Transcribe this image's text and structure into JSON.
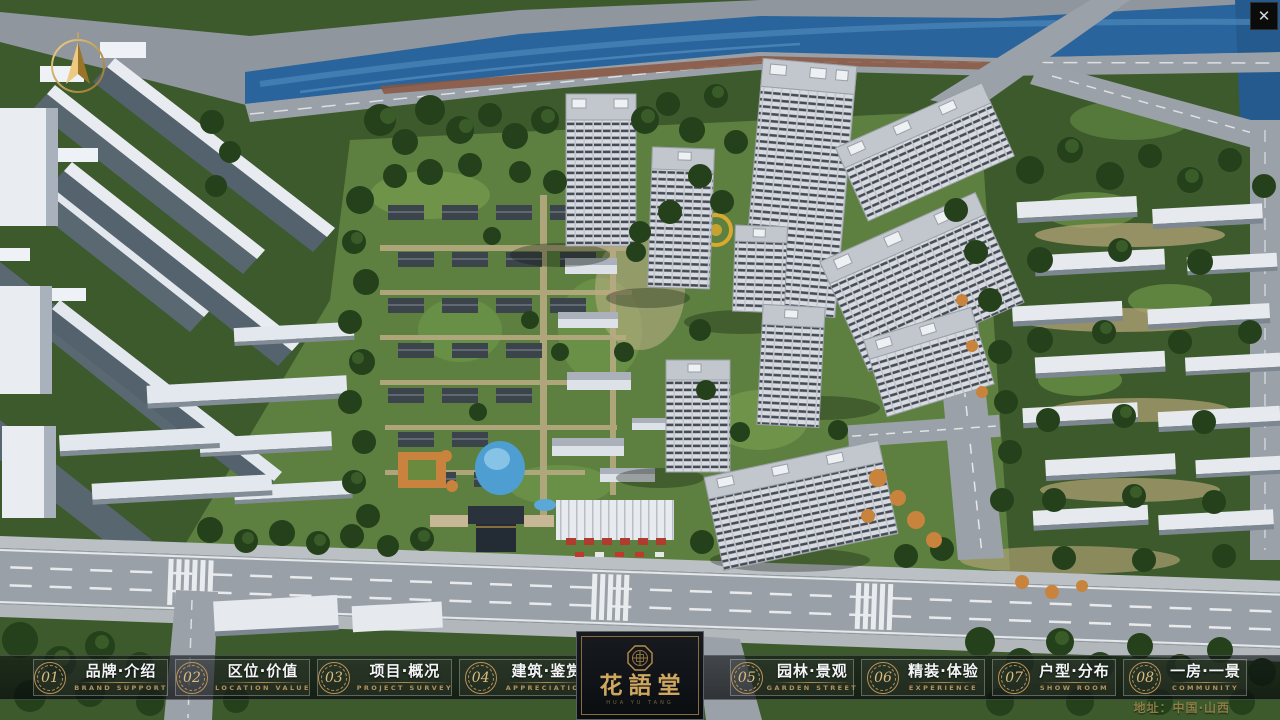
{
  "window": {
    "close_label": "✕"
  },
  "nav": {
    "items": [
      {
        "num": "01",
        "title": "品牌·介绍",
        "subtitle": "BRAND SUPPORT"
      },
      {
        "num": "02",
        "title": "区位·价值",
        "subtitle": "LOCATION VALUE"
      },
      {
        "num": "03",
        "title": "项目·概况",
        "subtitle": "PROJECT SURVEY"
      },
      {
        "num": "04",
        "title": "建筑·鉴赏",
        "subtitle": "APPRECIATION"
      },
      {
        "num": "05",
        "title": "园林·景观",
        "subtitle": "GARDEN STREET"
      },
      {
        "num": "06",
        "title": "精装·体验",
        "subtitle": "EXPERIENCE"
      },
      {
        "num": "07",
        "title": "户型·分布",
        "subtitle": "SHOW ROOM"
      },
      {
        "num": "08",
        "title": "一房·一景",
        "subtitle": "COMMUNITY"
      }
    ]
  },
  "logo": {
    "title": "花語堂",
    "caption": "HUA YU TANG"
  },
  "footer": {
    "address": "地址：中国·山西"
  },
  "colors": {
    "gold": "#c9a45c",
    "nav_border": "rgba(255,255,255,0.28)",
    "river": "#2a649c"
  }
}
